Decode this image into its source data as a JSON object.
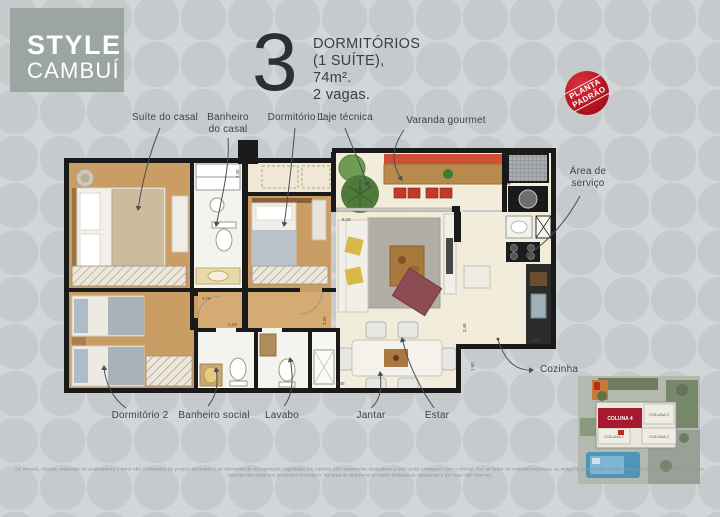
{
  "logo": {
    "line1": "STYLE",
    "line2": "CAMBUÍ"
  },
  "header": {
    "number": "3",
    "line1": "DORMITÓRIOS",
    "line2": "(1 SUÍTE),",
    "line3": "74m².",
    "line4": "2 vagas."
  },
  "stamp": {
    "line1": "PLANTA",
    "line2": "PADRÃO"
  },
  "plan_labels": {
    "suite": "Suíte do casal",
    "banheiro_casal_1": "Banheiro",
    "banheiro_casal_2": "do casal",
    "dormitorio1": "Dormitório 1",
    "laje": "Laje técnica",
    "varanda": "Varanda gourmet",
    "area_servico_1": "Área de",
    "area_servico_2": "serviço",
    "dormitorio2": "Dormitório 2",
    "banheiro_social": "Banheiro social",
    "lavabo": "Lavabo",
    "jantar": "Jantar",
    "estar": "Estar",
    "cozinha": "Cozinha"
  },
  "plan_dims": {
    "a": "3.75",
    "b": "0.70",
    "c": "5.18",
    "d": "3.48",
    "e": "1.80",
    "f": "4.45",
    "g": "2.00",
    "h": "3.20",
    "i": "2.38",
    "j": "1.23"
  },
  "site_map": {
    "coluna4": "COLUNA 4",
    "coluna3": "COLUNA 3",
    "coluna1": "COLUNA 1",
    "coluna2": "COLUNA 2"
  },
  "disclaimer": "Os móveis, objetos, materiais de acabamento e itens não constantes do projeto aprovado e do Memorial de Incorporação registrado em cartório são meramente ilustrativos e não serão entregues com o imóvel. Por se tratar de material impresso, as imagens podem não retratar fielmente as cores, brilhos e reflexos naturais dos materiais presentes no projeto. Na área do apartamento estão inclusas as alvenarias e as cotas são internas.",
  "colors": {
    "logo_bg": "#9ba5a2",
    "stamp_red": "#b3121d",
    "highlight_red": "#a6192e",
    "wood_floor": "#c99d63",
    "cream_floor": "#f2ecda",
    "wall_black": "#1a1a1a"
  }
}
